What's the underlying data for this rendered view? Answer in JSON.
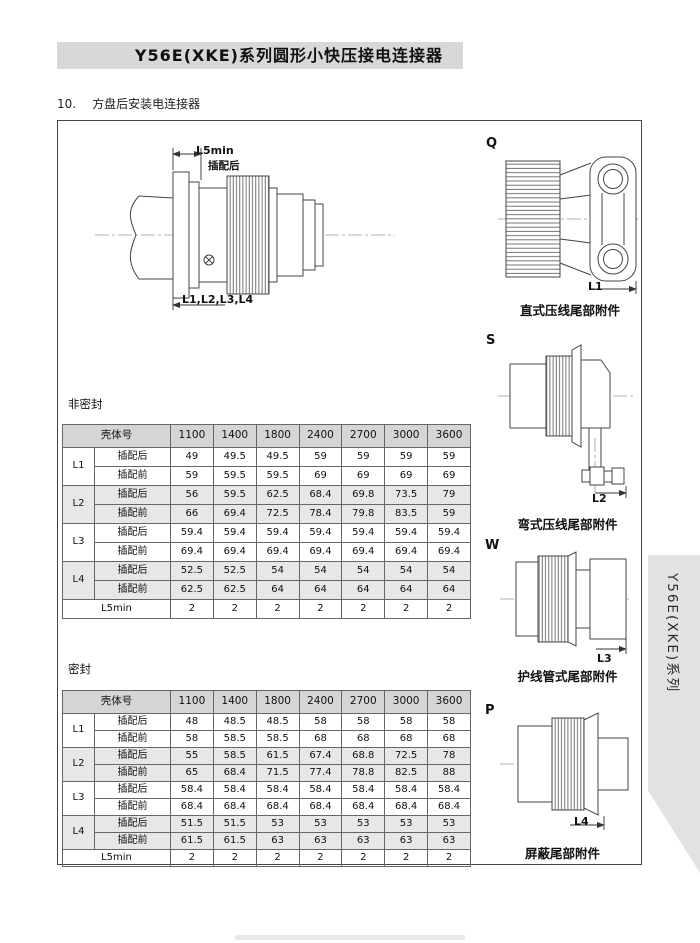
{
  "page": {
    "title": "Y56E(XKE)系列圆形小快压接电连接器",
    "section_no": "10.",
    "section_title": "方盘后安装电连接器",
    "side_tab": "Y56E(XKE)系列"
  },
  "main_drawing": {
    "dim_top": "L5min",
    "dim_top_sub": "插配后",
    "dim_bottom": "L1,L2,L3,L4"
  },
  "accessories": [
    {
      "letter": "Q",
      "dim": "L1",
      "caption": "直式压线尾部附件"
    },
    {
      "letter": "S",
      "dim": "L2",
      "caption": "弯式压线尾部附件"
    },
    {
      "letter": "W",
      "dim": "L3",
      "caption": "护线管式尾部附件"
    },
    {
      "letter": "P",
      "dim": "L4",
      "caption": "屏蔽尾部附件"
    }
  ],
  "tables": [
    {
      "label": "非密封",
      "header_label": "壳体号",
      "shell_sizes": [
        "1100",
        "1400",
        "1800",
        "2400",
        "2700",
        "3000",
        "3600"
      ],
      "groups": [
        {
          "name": "L1",
          "shaded": false,
          "rows": [
            {
              "label": "插配后",
              "values": [
                "49",
                "49.5",
                "49.5",
                "59",
                "59",
                "59",
                "59"
              ]
            },
            {
              "label": "插配前",
              "values": [
                "59",
                "59.5",
                "59.5",
                "69",
                "69",
                "69",
                "69"
              ]
            }
          ]
        },
        {
          "name": "L2",
          "shaded": true,
          "rows": [
            {
              "label": "插配后",
              "values": [
                "56",
                "59.5",
                "62.5",
                "68.4",
                "69.8",
                "73.5",
                "79"
              ]
            },
            {
              "label": "插配前",
              "values": [
                "66",
                "69.4",
                "72.5",
                "78.4",
                "79.8",
                "83.5",
                "59"
              ]
            }
          ]
        },
        {
          "name": "L3",
          "shaded": false,
          "rows": [
            {
              "label": "插配后",
              "values": [
                "59.4",
                "59.4",
                "59.4",
                "59.4",
                "59.4",
                "59.4",
                "59.4"
              ]
            },
            {
              "label": "插配前",
              "values": [
                "69.4",
                "69.4",
                "69.4",
                "69.4",
                "69.4",
                "69.4",
                "69.4"
              ]
            }
          ]
        },
        {
          "name": "L4",
          "shaded": true,
          "rows": [
            {
              "label": "插配后",
              "values": [
                "52.5",
                "52.5",
                "54",
                "54",
                "54",
                "54",
                "54"
              ]
            },
            {
              "label": "插配前",
              "values": [
                "62.5",
                "62.5",
                "64",
                "64",
                "64",
                "64",
                "64"
              ]
            }
          ]
        }
      ],
      "footer": {
        "label": "L5min",
        "values": [
          "2",
          "2",
          "2",
          "2",
          "2",
          "2",
          "2"
        ]
      }
    },
    {
      "label": "密封",
      "header_label": "壳体号",
      "shell_sizes": [
        "1100",
        "1400",
        "1800",
        "2400",
        "2700",
        "3000",
        "3600"
      ],
      "groups": [
        {
          "name": "L1",
          "shaded": false,
          "rows": [
            {
              "label": "插配后",
              "values": [
                "48",
                "48.5",
                "48.5",
                "58",
                "58",
                "58",
                "58"
              ]
            },
            {
              "label": "插配前",
              "values": [
                "58",
                "58.5",
                "58.5",
                "68",
                "68",
                "68",
                "68"
              ]
            }
          ]
        },
        {
          "name": "L2",
          "shaded": true,
          "rows": [
            {
              "label": "插配后",
              "values": [
                "55",
                "58.5",
                "61.5",
                "67.4",
                "68.8",
                "72.5",
                "78"
              ]
            },
            {
              "label": "插配前",
              "values": [
                "65",
                "68.4",
                "71.5",
                "77.4",
                "78.8",
                "82.5",
                "88"
              ]
            }
          ]
        },
        {
          "name": "L3",
          "shaded": false,
          "rows": [
            {
              "label": "插配后",
              "values": [
                "58.4",
                "58.4",
                "58.4",
                "58.4",
                "58.4",
                "58.4",
                "58.4"
              ]
            },
            {
              "label": "插配前",
              "values": [
                "68.4",
                "68.4",
                "68.4",
                "68.4",
                "68.4",
                "68.4",
                "68.4"
              ]
            }
          ]
        },
        {
          "name": "L4",
          "shaded": true,
          "rows": [
            {
              "label": "插配后",
              "values": [
                "51.5",
                "51.5",
                "53",
                "53",
                "53",
                "53",
                "53"
              ]
            },
            {
              "label": "插配前",
              "values": [
                "61.5",
                "61.5",
                "63",
                "63",
                "63",
                "63",
                "63"
              ]
            }
          ]
        }
      ],
      "footer": {
        "label": "L5min",
        "values": [
          "2",
          "2",
          "2",
          "2",
          "2",
          "2",
          "2"
        ]
      }
    }
  ],
  "colors": {
    "title_band": "#d8d8d8",
    "table_header": "#d5d5d5",
    "row_shade": "#e7e7e7",
    "side_tab": "#e2e2e2"
  }
}
